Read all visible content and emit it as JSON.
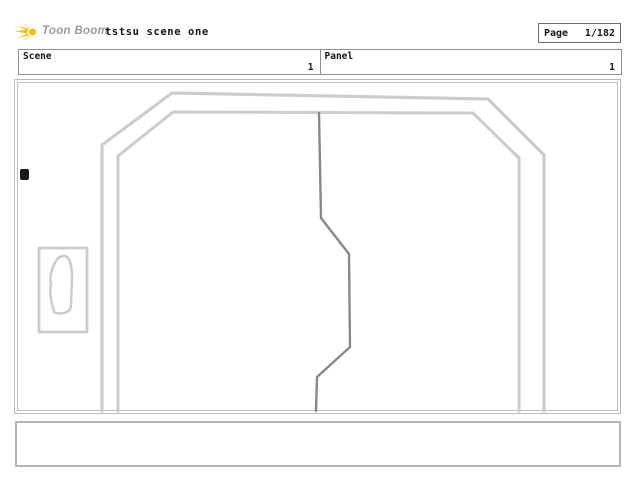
{
  "header": {
    "brand": "Toon Boom",
    "title": "tstsu scene one",
    "page_box": {
      "label": "Page",
      "value": "1/182"
    }
  },
  "info_row": {
    "scene": {
      "label": "Scene",
      "value": "1"
    },
    "panel": {
      "label": "Panel",
      "value": "1"
    }
  },
  "caption": {
    "text": ""
  },
  "colors": {
    "brand_yellow": "#f0c11d",
    "brand_text_gray": "#9b9b9b",
    "page_box_border": "#6e6e6e",
    "info_border": "#8e8e8e",
    "panel_border": "#b9b9b9",
    "sketch_light": "#cccccc",
    "sketch_dark": "#888888",
    "ink_dot": "#1a1a1a"
  },
  "drawing": {
    "colors": {
      "light": "#cccccc",
      "dark": "#888888",
      "ink": "#1a1a1a"
    },
    "polylines": [
      {
        "name": "door-frame-outer",
        "color": "light",
        "width": 3.2,
        "points": "102,411 102,145 172,93 488,99 544,155 544,411"
      },
      {
        "name": "door-frame-inner",
        "color": "light",
        "width": 3,
        "points": "118,411 118,156 173,112 473,113 519,158 519,411"
      },
      {
        "name": "door-split-line",
        "color": "dark",
        "width": 2.4,
        "points": "319,113 321,218 349,254 350,347 317,377 316,411"
      },
      {
        "name": "wall-plate",
        "color": "light",
        "width": 2.8,
        "points": "39,248 87,248 87,332 39,332 39,248"
      }
    ],
    "paths": [
      {
        "name": "plate-blob",
        "color": "light",
        "width": 2.5,
        "d": "M54,312 C51,300 49,291 51,284 C49,278 52,267 56,261 C59,256 65,254 68,258 C71,262 72,269 72,279 L71,305 C71,310 68,312 64,313 C60,314 56,313 54,312 Z"
      }
    ],
    "dot": {
      "x": 20,
      "y": 169,
      "width": 9,
      "height": 11
    }
  }
}
